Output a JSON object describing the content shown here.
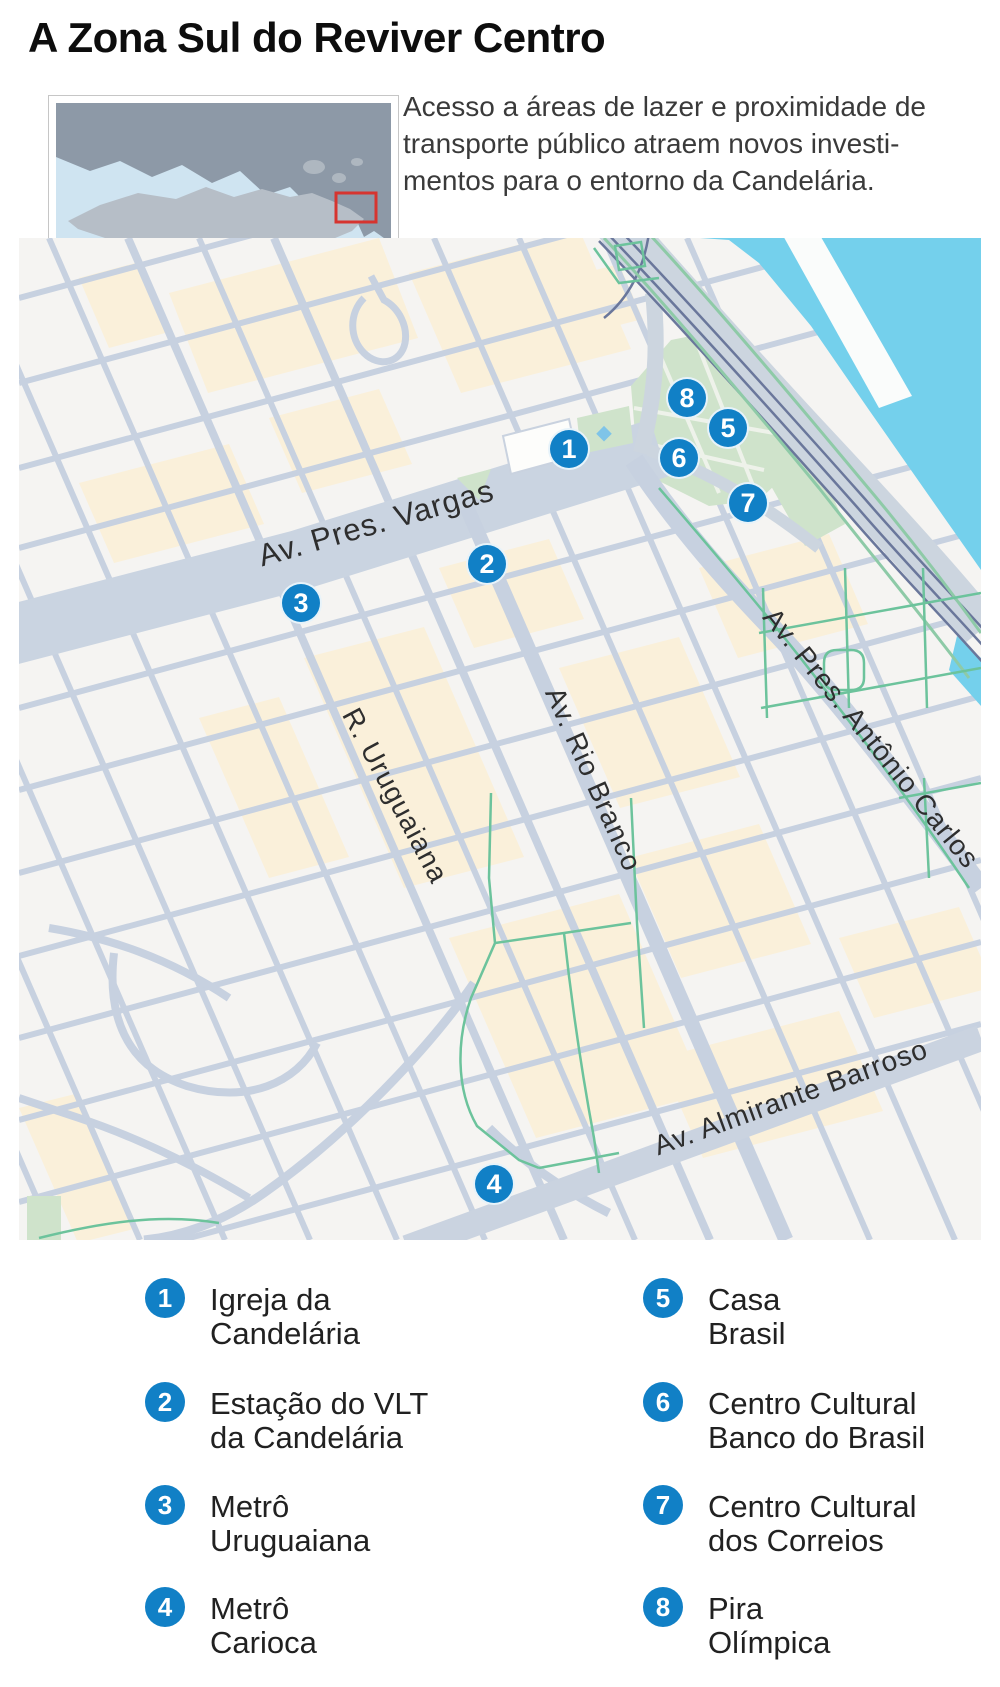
{
  "header": {
    "title": "A Zona Sul do Reviver Centro",
    "intro_lines": [
      "Acesso a áreas de lazer e proximidade de",
      "transporte público atraem novos investi-",
      "mentos para o entorno da Candelária."
    ]
  },
  "map": {
    "street_labels": [
      {
        "text": "Av. Pres. Vargas"
      },
      {
        "text": "Av. Rio Branco"
      },
      {
        "text": "R. Uruguaiana"
      },
      {
        "text": "Av. Pres. Antônio Carlos"
      },
      {
        "text": "Av. Almirante Barroso"
      }
    ],
    "markers": [
      {
        "number": "1"
      },
      {
        "number": "2"
      },
      {
        "number": "3"
      },
      {
        "number": "4"
      },
      {
        "number": "5"
      },
      {
        "number": "6"
      },
      {
        "number": "7"
      },
      {
        "number": "8"
      }
    ]
  },
  "legend": {
    "items": [
      {
        "number": "1",
        "line1": "Igreja da",
        "line2": "Candelária"
      },
      {
        "number": "2",
        "line1": "Estação do VLT",
        "line2": "da Candelária"
      },
      {
        "number": "3",
        "line1": "Metrô",
        "line2": "Uruguaiana"
      },
      {
        "number": "4",
        "line1": "Metrô",
        "line2": "Carioca"
      },
      {
        "number": "5",
        "line1": "Casa",
        "line2": "Brasil"
      },
      {
        "number": "6",
        "line1": "Centro Cultural",
        "line2": "Banco do Brasil"
      },
      {
        "number": "7",
        "line1": "Centro Cultural",
        "line2": "dos Correios"
      },
      {
        "number": "8",
        "line1": "Pira",
        "line2": "Olímpica"
      }
    ]
  },
  "colors": {
    "marker_blue": "#1180c6",
    "water": "#74d0ec",
    "inset_water": "#cfe4f1",
    "park": "#cfe3cb",
    "bike_path": "#6cc39c",
    "road": "#c7d1e0",
    "block_beige": "#faf0da",
    "highlight_red": "#d6342f"
  }
}
